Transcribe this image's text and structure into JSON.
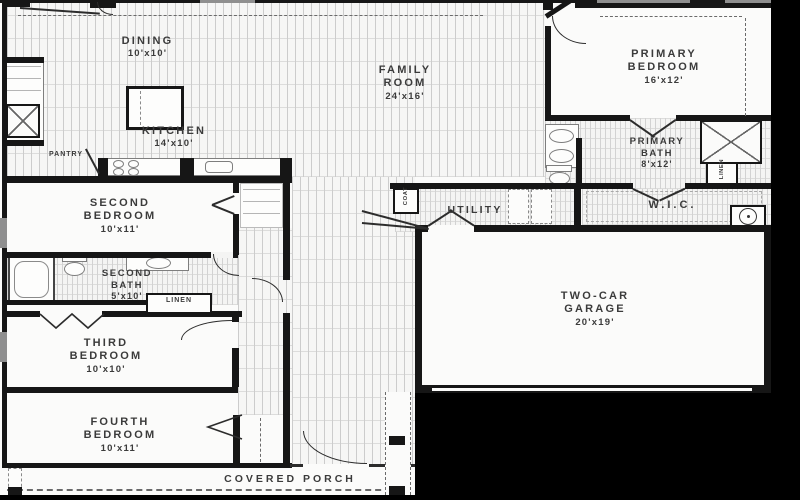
{
  "title": "single-story-house-floor-plan",
  "colors": {
    "wall": "#161616",
    "hatch_line": "#cccccc",
    "floor": "#f6f6f5",
    "text": "#3b3b3b",
    "mask": "#000000"
  },
  "rooms": {
    "dining": {
      "name": "DINING",
      "dims": "10'x10'"
    },
    "kitchen": {
      "name": "KITCHEN",
      "dims": "14'x10'"
    },
    "family_room": {
      "line1": "FAMILY",
      "line2": "ROOM",
      "dims": "24'x16'"
    },
    "primary_bedroom": {
      "line1": "PRIMARY",
      "line2": "BEDROOM",
      "dims": "16'x12'"
    },
    "primary_bath": {
      "line1": "PRIMARY",
      "line2": "BATH",
      "dims": "8'x12'"
    },
    "second_bedroom": {
      "line1": "SECOND",
      "line2": "BEDROOM",
      "dims": "10'x11'"
    },
    "second_bath": {
      "line1": "SECOND",
      "line2": "BATH",
      "dims": "5'x10'"
    },
    "third_bedroom": {
      "line1": "THIRD",
      "line2": "BEDROOM",
      "dims": "10'x10'"
    },
    "fourth_bedroom": {
      "line1": "FOURTH",
      "line2": "BEDROOM",
      "dims": "10'x11'"
    },
    "garage": {
      "line1": "TWO-CAR",
      "line2": "GARAGE",
      "dims": "20'x19'"
    },
    "utility": {
      "name": "UTILITY"
    },
    "wic": {
      "name": "W.I.C."
    },
    "pantry": {
      "name": "PANTRY"
    },
    "coat": {
      "name": "COAT"
    },
    "linen_hall": {
      "name": "LINEN"
    },
    "linen_bath": {
      "name": "LINEN"
    },
    "covered_porch": {
      "name": "COVERED PORCH"
    }
  },
  "fixtures": [
    "kitchen-island",
    "range-burners",
    "kitchen-sink",
    "pantry-shelves",
    "closet-shelves",
    "double-vanity-sinks",
    "toilet",
    "walk-in-shower",
    "washer-dryer",
    "water-heater",
    "bathtub",
    "vanity-sink",
    "linen-closet",
    "porch-posts",
    "garage-door"
  ]
}
